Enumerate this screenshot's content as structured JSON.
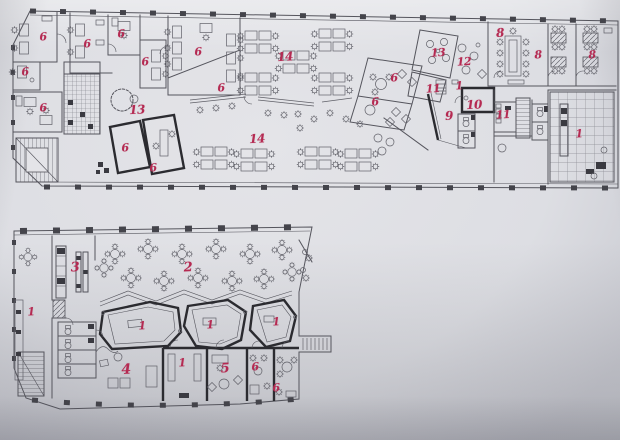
{
  "page": {
    "background_hex": "#c7c9cf",
    "paper_hex": "#e4e4e8",
    "ink_hex": "#55555d",
    "bold_ink_hex": "#2b2b30",
    "label_hex": "#b52a52"
  },
  "plans": {
    "upper": {
      "labels": [
        {
          "t": "6",
          "x": 43,
          "y": 37
        },
        {
          "t": "6",
          "x": 87,
          "y": 44
        },
        {
          "t": "6",
          "x": 121,
          "y": 34
        },
        {
          "t": "6",
          "x": 145,
          "y": 62
        },
        {
          "t": "6",
          "x": 198,
          "y": 52
        },
        {
          "t": "6",
          "x": 221,
          "y": 88
        },
        {
          "t": "14",
          "x": 285,
          "y": 57,
          "s": 12
        },
        {
          "t": "6",
          "x": 25,
          "y": 72
        },
        {
          "t": "6",
          "x": 43,
          "y": 108
        },
        {
          "t": "13",
          "x": 137,
          "y": 110,
          "s": 12
        },
        {
          "t": "6",
          "x": 125,
          "y": 148
        },
        {
          "t": "6",
          "x": 153,
          "y": 168
        },
        {
          "t": "14",
          "x": 257,
          "y": 139,
          "s": 12
        },
        {
          "t": "6",
          "x": 394,
          "y": 78
        },
        {
          "t": "6",
          "x": 375,
          "y": 102
        },
        {
          "t": "13",
          "x": 438,
          "y": 53
        },
        {
          "t": "12",
          "x": 464,
          "y": 62
        },
        {
          "t": "11",
          "x": 433,
          "y": 89
        },
        {
          "t": "1",
          "x": 459,
          "y": 86
        },
        {
          "t": "10",
          "x": 474,
          "y": 105,
          "s": 12
        },
        {
          "t": "9",
          "x": 449,
          "y": 116,
          "s": 12
        },
        {
          "t": "11",
          "x": 503,
          "y": 115
        },
        {
          "t": "8",
          "x": 500,
          "y": 33,
          "s": 12
        },
        {
          "t": "8",
          "x": 538,
          "y": 55
        },
        {
          "t": "8",
          "x": 592,
          "y": 55
        },
        {
          "t": "1",
          "x": 579,
          "y": 134
        }
      ]
    },
    "lower": {
      "labels": [
        {
          "t": "3",
          "x": 75,
          "y": 268,
          "s": 13
        },
        {
          "t": "2",
          "x": 188,
          "y": 268,
          "s": 13
        },
        {
          "t": "1",
          "x": 31,
          "y": 312
        },
        {
          "t": "1",
          "x": 142,
          "y": 326
        },
        {
          "t": "1",
          "x": 210,
          "y": 325
        },
        {
          "t": "1",
          "x": 276,
          "y": 322
        },
        {
          "t": "1",
          "x": 182,
          "y": 363
        },
        {
          "t": "4",
          "x": 126,
          "y": 370,
          "s": 14
        },
        {
          "t": "5",
          "x": 225,
          "y": 369,
          "s": 13
        },
        {
          "t": "6",
          "x": 255,
          "y": 367
        },
        {
          "t": "6",
          "x": 276,
          "y": 388
        }
      ]
    }
  }
}
